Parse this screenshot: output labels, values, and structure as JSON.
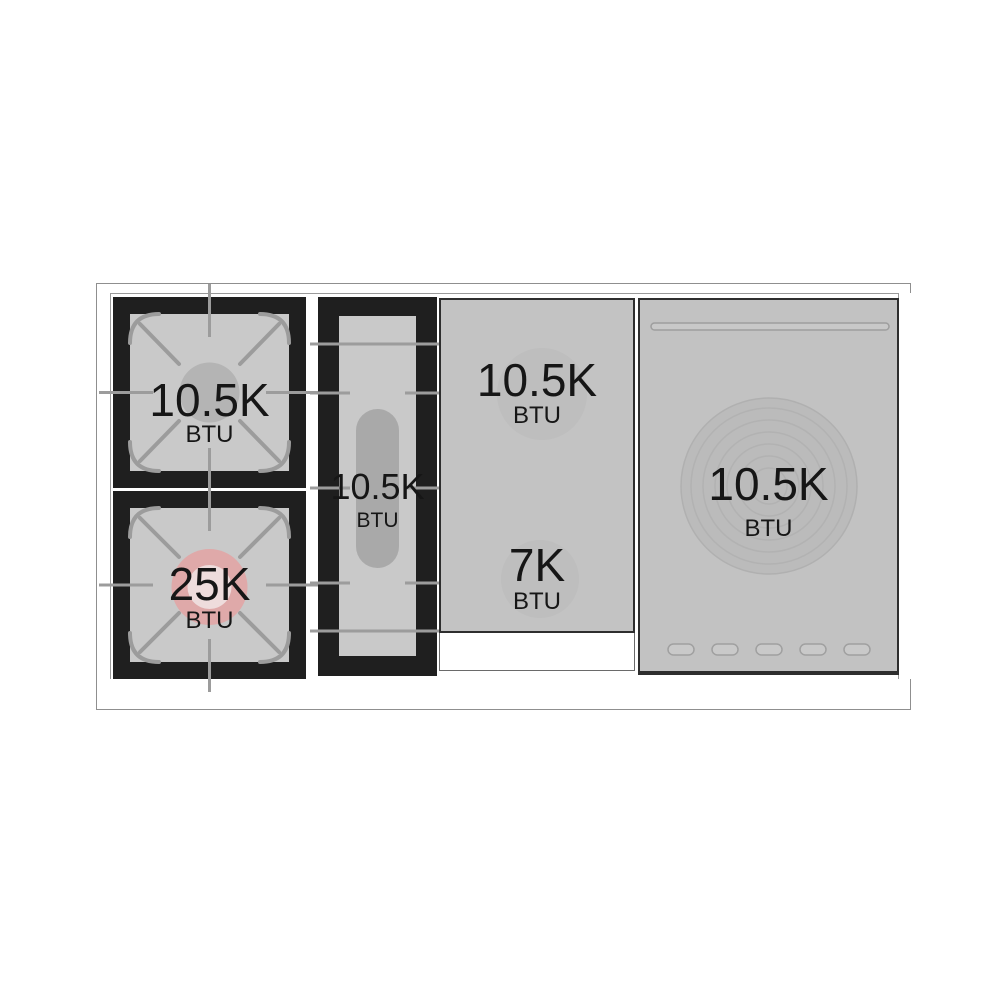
{
  "cooktop": {
    "burners": [
      {
        "id": "rear-left-gas-burner",
        "power": "10.5K",
        "unit": "BTU"
      },
      {
        "id": "front-left-gas-burner",
        "power": "25K",
        "unit": "BTU",
        "highlighted": true
      },
      {
        "id": "center-oval-burner",
        "power": "10.5K",
        "unit": "BTU"
      },
      {
        "id": "griddle-rear-burner",
        "power": "10.5K",
        "unit": "BTU"
      },
      {
        "id": "griddle-front-burner",
        "power": "7K",
        "unit": "BTU"
      },
      {
        "id": "right-round-element",
        "power": "10.5K",
        "unit": "BTU"
      }
    ],
    "colors": {
      "background": "#ffffff",
      "grate_frame_black": "#1f1f1f",
      "grate_surface_gray": "#c9c9c9",
      "panel_gray": "#c3c3c3",
      "line_gray": "#9c9c9c",
      "burner_circle_gray": "#b4b4b4",
      "highlight_pink": "#dfa9a9",
      "highlight_pink_inner": "#eedcdc",
      "oval_capsule_gray": "#a9a9a9",
      "text": "#161616"
    }
  }
}
